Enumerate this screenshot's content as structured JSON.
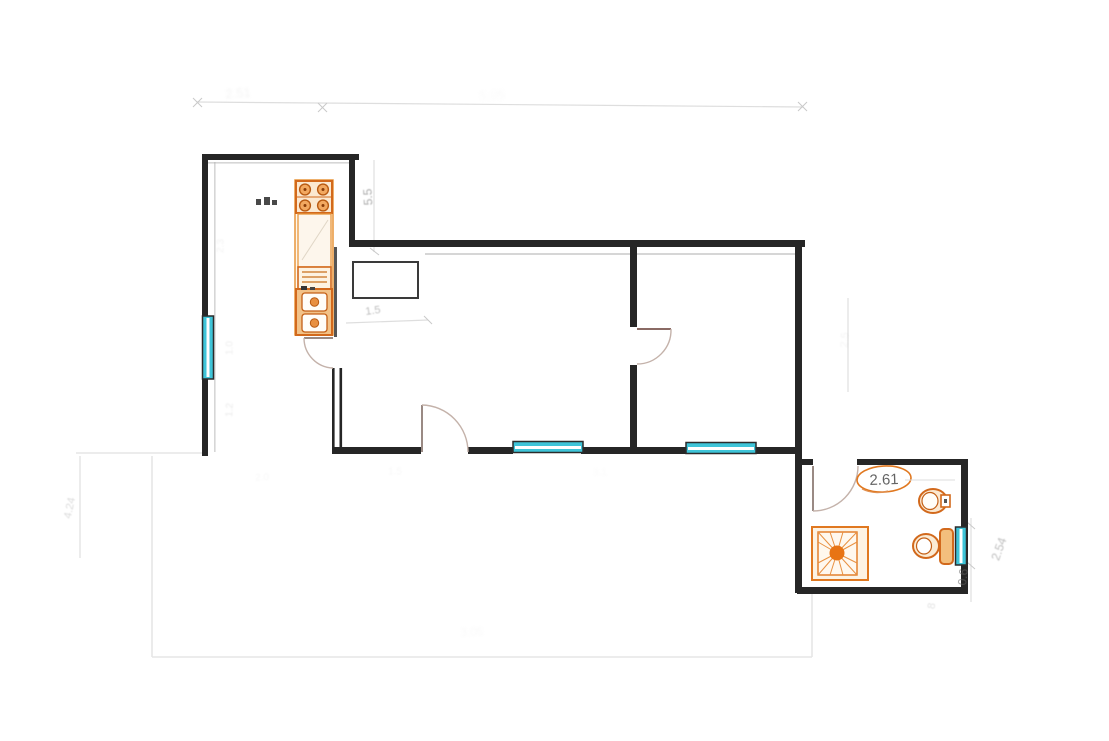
{
  "drawing": {
    "kind": "apartment floor plan sketch",
    "background": "#ffffff"
  },
  "colors": {
    "wall": "#262626",
    "cyan_window": "#3ec4d8",
    "fixture_orange": "#d9711c",
    "fixture_fill": "#fdf3e2",
    "door_arc": "#c4b2aa",
    "faint_line": "#dedede"
  },
  "fixtures": {
    "stove": "stove-icon",
    "kitchen_sink": "sink-icon",
    "dish_drainer": "drainer-icon",
    "shower": "shower-icon",
    "toilet": "toilet-icon",
    "bidet": "bidet-icon"
  },
  "dimension_labels": [
    {
      "value": "2.51",
      "x": 238,
      "y": 93,
      "rot": -4,
      "size": 13,
      "color": "#b8b8b8",
      "opacity": 0.16,
      "blur": 1.2
    },
    {
      "value": "5.05",
      "x": 492,
      "y": 95,
      "rot": -3,
      "size": 13,
      "color": "#c2c2c2",
      "opacity": 0.1,
      "blur": 1.5
    },
    {
      "value": "5.5",
      "x": 368,
      "y": 197,
      "rot": -93,
      "size": 12,
      "color": "#555555",
      "opacity": 0.5,
      "blur": 0.4
    },
    {
      "value": "1.5",
      "x": 373,
      "y": 311,
      "rot": -8,
      "size": 11,
      "color": "#666666",
      "opacity": 0.42,
      "blur": 0.4
    },
    {
      "value": "2.3",
      "x": 221,
      "y": 246,
      "rot": -88,
      "size": 10,
      "color": "#999999",
      "opacity": 0.12,
      "blur": 0.8
    },
    {
      "value": "1.0",
      "x": 230,
      "y": 348,
      "rot": -90,
      "size": 10,
      "color": "#888888",
      "opacity": 0.15,
      "blur": 0.7
    },
    {
      "value": "1.2",
      "x": 230,
      "y": 410,
      "rot": -87,
      "size": 10,
      "color": "#888888",
      "opacity": 0.18,
      "blur": 0.7
    },
    {
      "value": "4.24",
      "x": 70,
      "y": 508,
      "rot": -78,
      "size": 11,
      "color": "#999999",
      "opacity": 0.35,
      "blur": 0.5
    },
    {
      "value": "2.61",
      "x": 884,
      "y": 480,
      "rot": -2,
      "size": 15,
      "color": "#4a4a4a",
      "opacity": 0.85,
      "blur": 0
    },
    {
      "value": "0.6",
      "x": 963,
      "y": 577,
      "rot": -84,
      "size": 12,
      "color": "#666666",
      "opacity": 0.6,
      "blur": 0.3
    },
    {
      "value": "2.54",
      "x": 999,
      "y": 549,
      "rot": -70,
      "size": 12,
      "color": "#8a8a8a",
      "opacity": 0.55,
      "blur": 0.4
    },
    {
      "value": "2.5",
      "x": 845,
      "y": 340,
      "rot": -85,
      "size": 11,
      "color": "#aaaaaa",
      "opacity": 0.12,
      "blur": 0.8
    },
    {
      "value": "3.05",
      "x": 472,
      "y": 632,
      "rot": -2,
      "size": 12,
      "color": "#bbbbbb",
      "opacity": 0.09,
      "blur": 1.2
    },
    {
      "value": "1.5",
      "x": 395,
      "y": 472,
      "rot": 0,
      "size": 10,
      "color": "#bbbbbb",
      "opacity": 0.1,
      "blur": 0.9
    },
    {
      "value": "3.1",
      "x": 600,
      "y": 473,
      "rot": 0,
      "size": 10,
      "color": "#bbbbbb",
      "opacity": 0.08,
      "blur": 1.0
    },
    {
      "value": "2.0",
      "x": 262,
      "y": 478,
      "rot": -3,
      "size": 10,
      "color": "#bbbbbb",
      "opacity": 0.1,
      "blur": 0.9
    },
    {
      "value": "8",
      "x": 932,
      "y": 606,
      "rot": -80,
      "size": 11,
      "color": "#999999",
      "opacity": 0.28,
      "blur": 0.4
    }
  ]
}
